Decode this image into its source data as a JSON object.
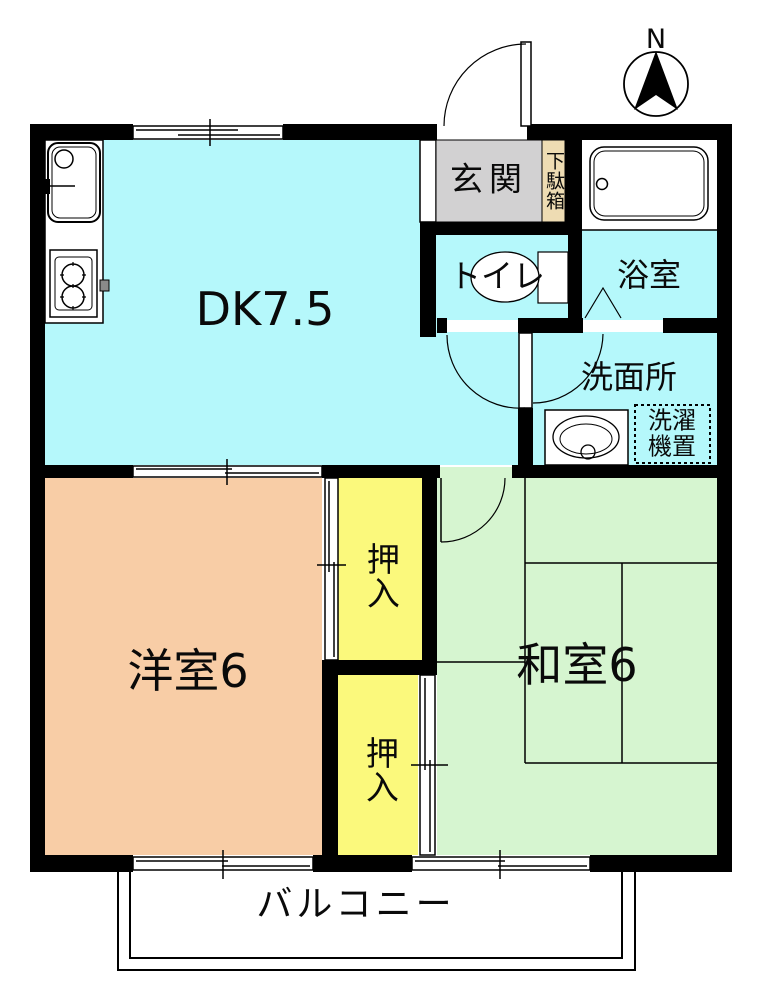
{
  "plan": {
    "title": "2DK apartment floor plan",
    "rooms": {
      "dk": "DK7.5",
      "entrance": "玄関",
      "shoe_cabinet": "下駄箱",
      "bathroom": "浴室",
      "toilet": "トイレ",
      "washroom": "洗面所",
      "laundry_line1": "洗濯",
      "laundry_line2": "機置",
      "western_room": "洋室6",
      "japanese_room": "和室6",
      "closet_upper": "押入",
      "closet_lower": "押入",
      "balcony": "バルコニー"
    },
    "compass": {
      "north": "N"
    },
    "colors": {
      "dk_floor": "#b5f8fb",
      "western_floor": "#f8cda6",
      "japanese_floor": "#d6f5d0",
      "closet_floor": "#fbf97c",
      "entrance_floor": "#d2d1d2",
      "shoe_cabinet_fill": "#eedcb3",
      "fixture_fill": "#ffffff",
      "knob_gray": "#8a8a8a",
      "wall": "#000000",
      "line": "#000000",
      "background": "#ffffff"
    }
  }
}
